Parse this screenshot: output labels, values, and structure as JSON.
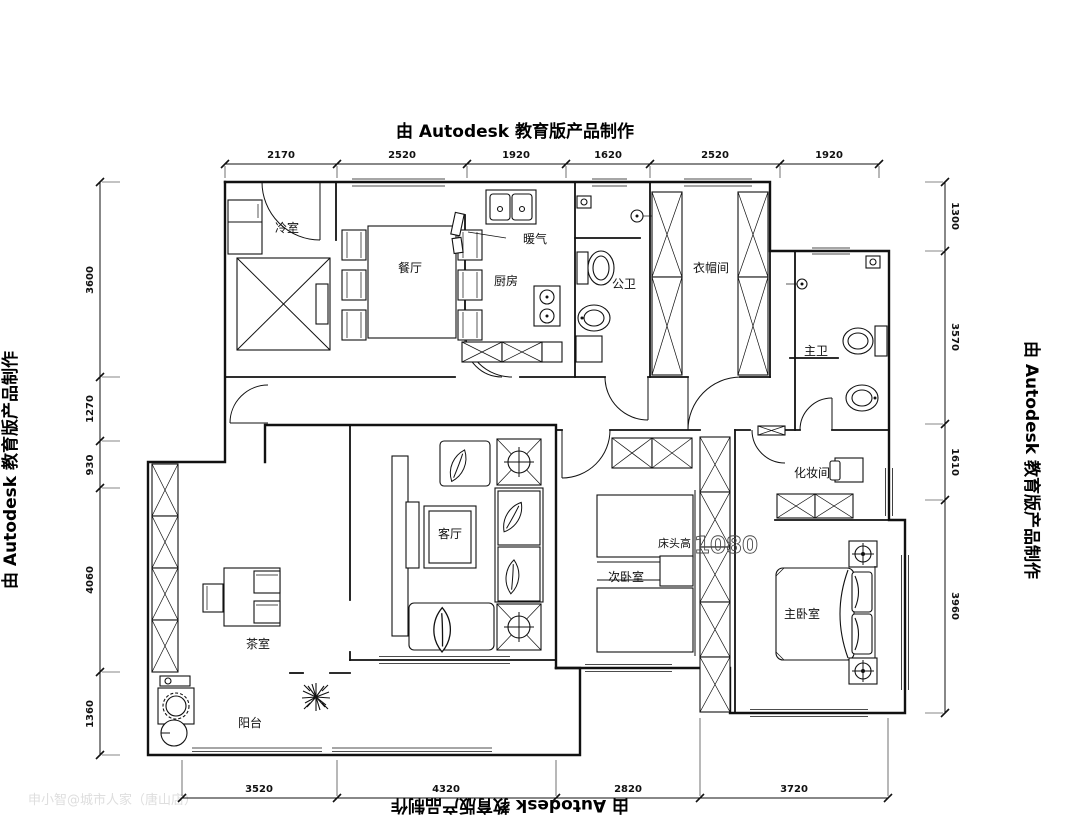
{
  "watermarks": {
    "autodesk": "由 Autodesk 教育版产品制作",
    "credit": "申小智@城市人家（唐山店）"
  },
  "colors": {
    "line": "#111111",
    "watermark": "#000000",
    "credit_gray": "#dedede"
  },
  "rooms": {
    "cold_room": "冷室",
    "dining": "餐厅",
    "kitchen": "厨房",
    "radiator": "暖气",
    "public_bath": "公卫",
    "cloakroom": "衣帽间",
    "master_bath": "主卫",
    "living": "客厅",
    "second_bedroom": "次卧室",
    "bed_head_note": "床头高",
    "bed_head_value": "1080",
    "makeup_room": "化妆间",
    "master_bedroom": "主卧室",
    "tea_room": "茶室",
    "balcony": "阳台"
  },
  "dimensions": {
    "top": [
      "2170",
      "2520",
      "1920",
      "1620",
      "2520",
      "1920"
    ],
    "bottom": [
      "3520",
      "4320",
      "2820",
      "3720"
    ],
    "left": [
      "3600",
      "1270",
      "930",
      "4060",
      "1360"
    ],
    "right": [
      "1300",
      "3570",
      "1610",
      "3960"
    ]
  }
}
